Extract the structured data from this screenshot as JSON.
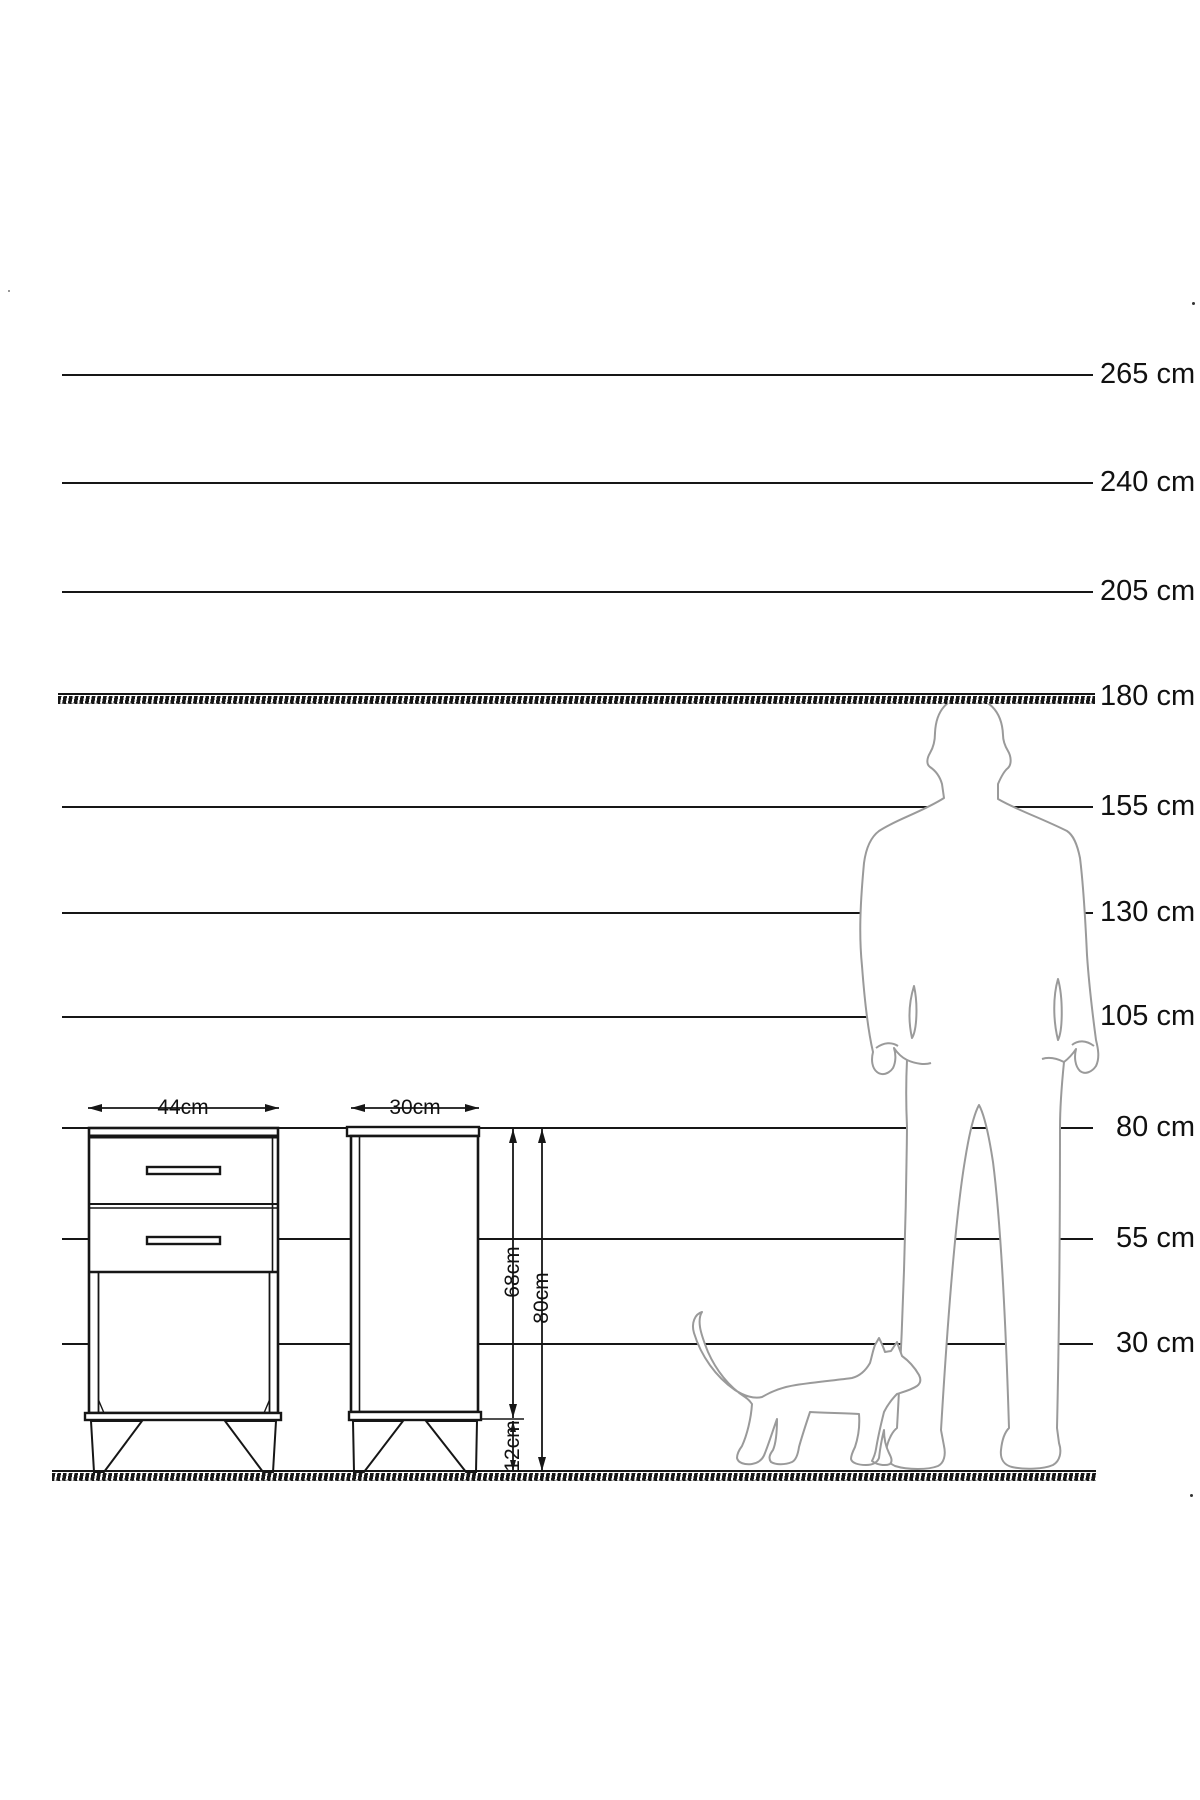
{
  "scale": {
    "unit": "cm",
    "labels": [
      "265 cm",
      "240 cm",
      "205 cm",
      "180 cm",
      "155 cm",
      "130 cm",
      "105 cm",
      "80 cm",
      "55 cm",
      "30 cm"
    ],
    "values": [
      265,
      240,
      205,
      180,
      155,
      130,
      105,
      80,
      55,
      30
    ],
    "hatched_lines": [
      "180 cm",
      "ground"
    ]
  },
  "furniture": {
    "front_view": {
      "width_label": "44cm",
      "drawer_count": 2
    },
    "side_view": {
      "width_label": "30cm"
    },
    "heights": {
      "body_label": "68cm",
      "total_label": "80cm",
      "legs_label": "12cm"
    }
  },
  "figures": {
    "man": "man-silhouette",
    "cat": "cat-silhouette"
  },
  "colors": {
    "ink": "#161616",
    "silhouette": "#9a9a9a",
    "background": "#ffffff"
  }
}
